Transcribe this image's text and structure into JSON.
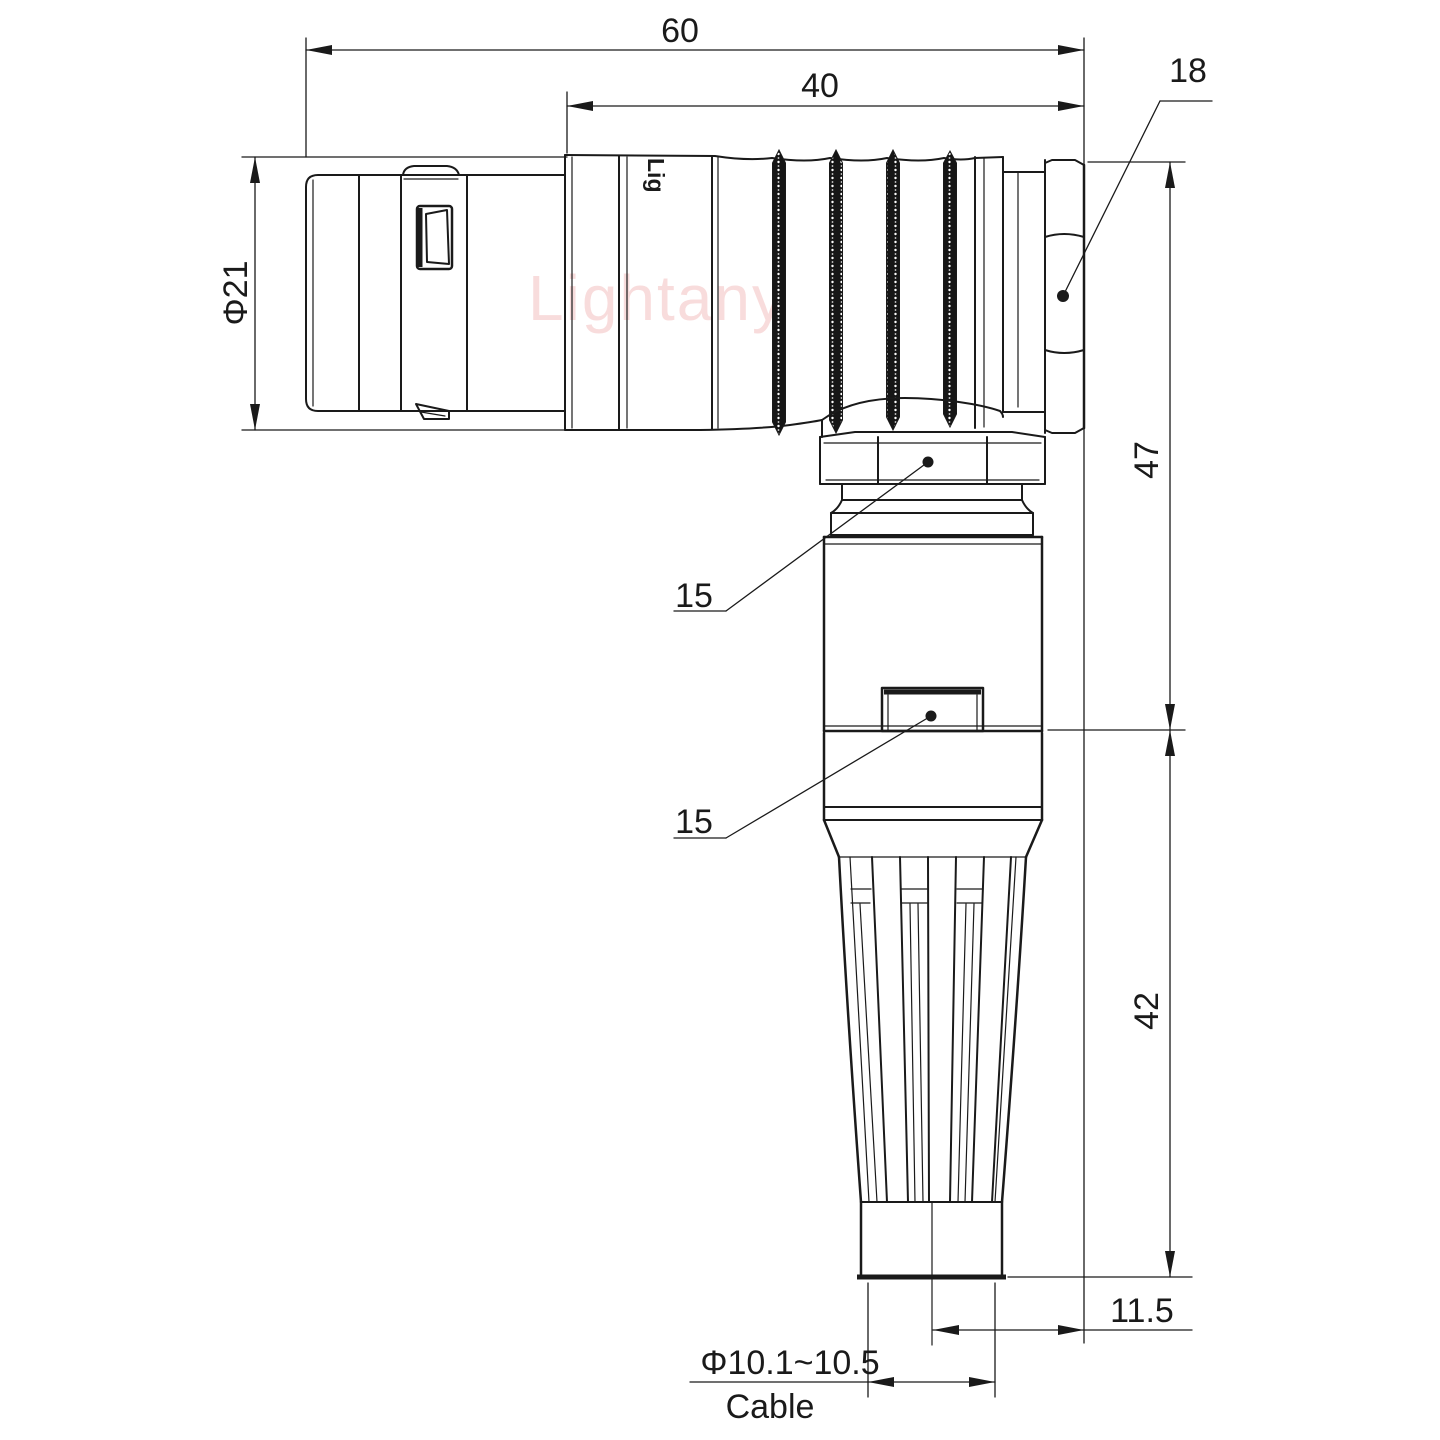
{
  "drawing": {
    "type": "technical-drawing",
    "subject": "right-angle circular connector side view",
    "watermark": {
      "text": "Lightany",
      "color": "#f5c6c6"
    },
    "brand_mark": "Lig",
    "dimensions": {
      "overall_length": "60",
      "rear_section_length": "40",
      "hex_nut_width": "18",
      "shell_diameter": "Φ21",
      "upper_height": "47",
      "lower_height": "42",
      "coupling_nut_label": "15",
      "clamp_section_label": "15",
      "cable_axis_offset": "11.5",
      "cable_diameter": "Φ10.1~10.5",
      "cable_label": "Cable"
    },
    "colors": {
      "line": "#1a1a1a",
      "background": "#ffffff",
      "watermark": "#f5c6c6"
    }
  }
}
